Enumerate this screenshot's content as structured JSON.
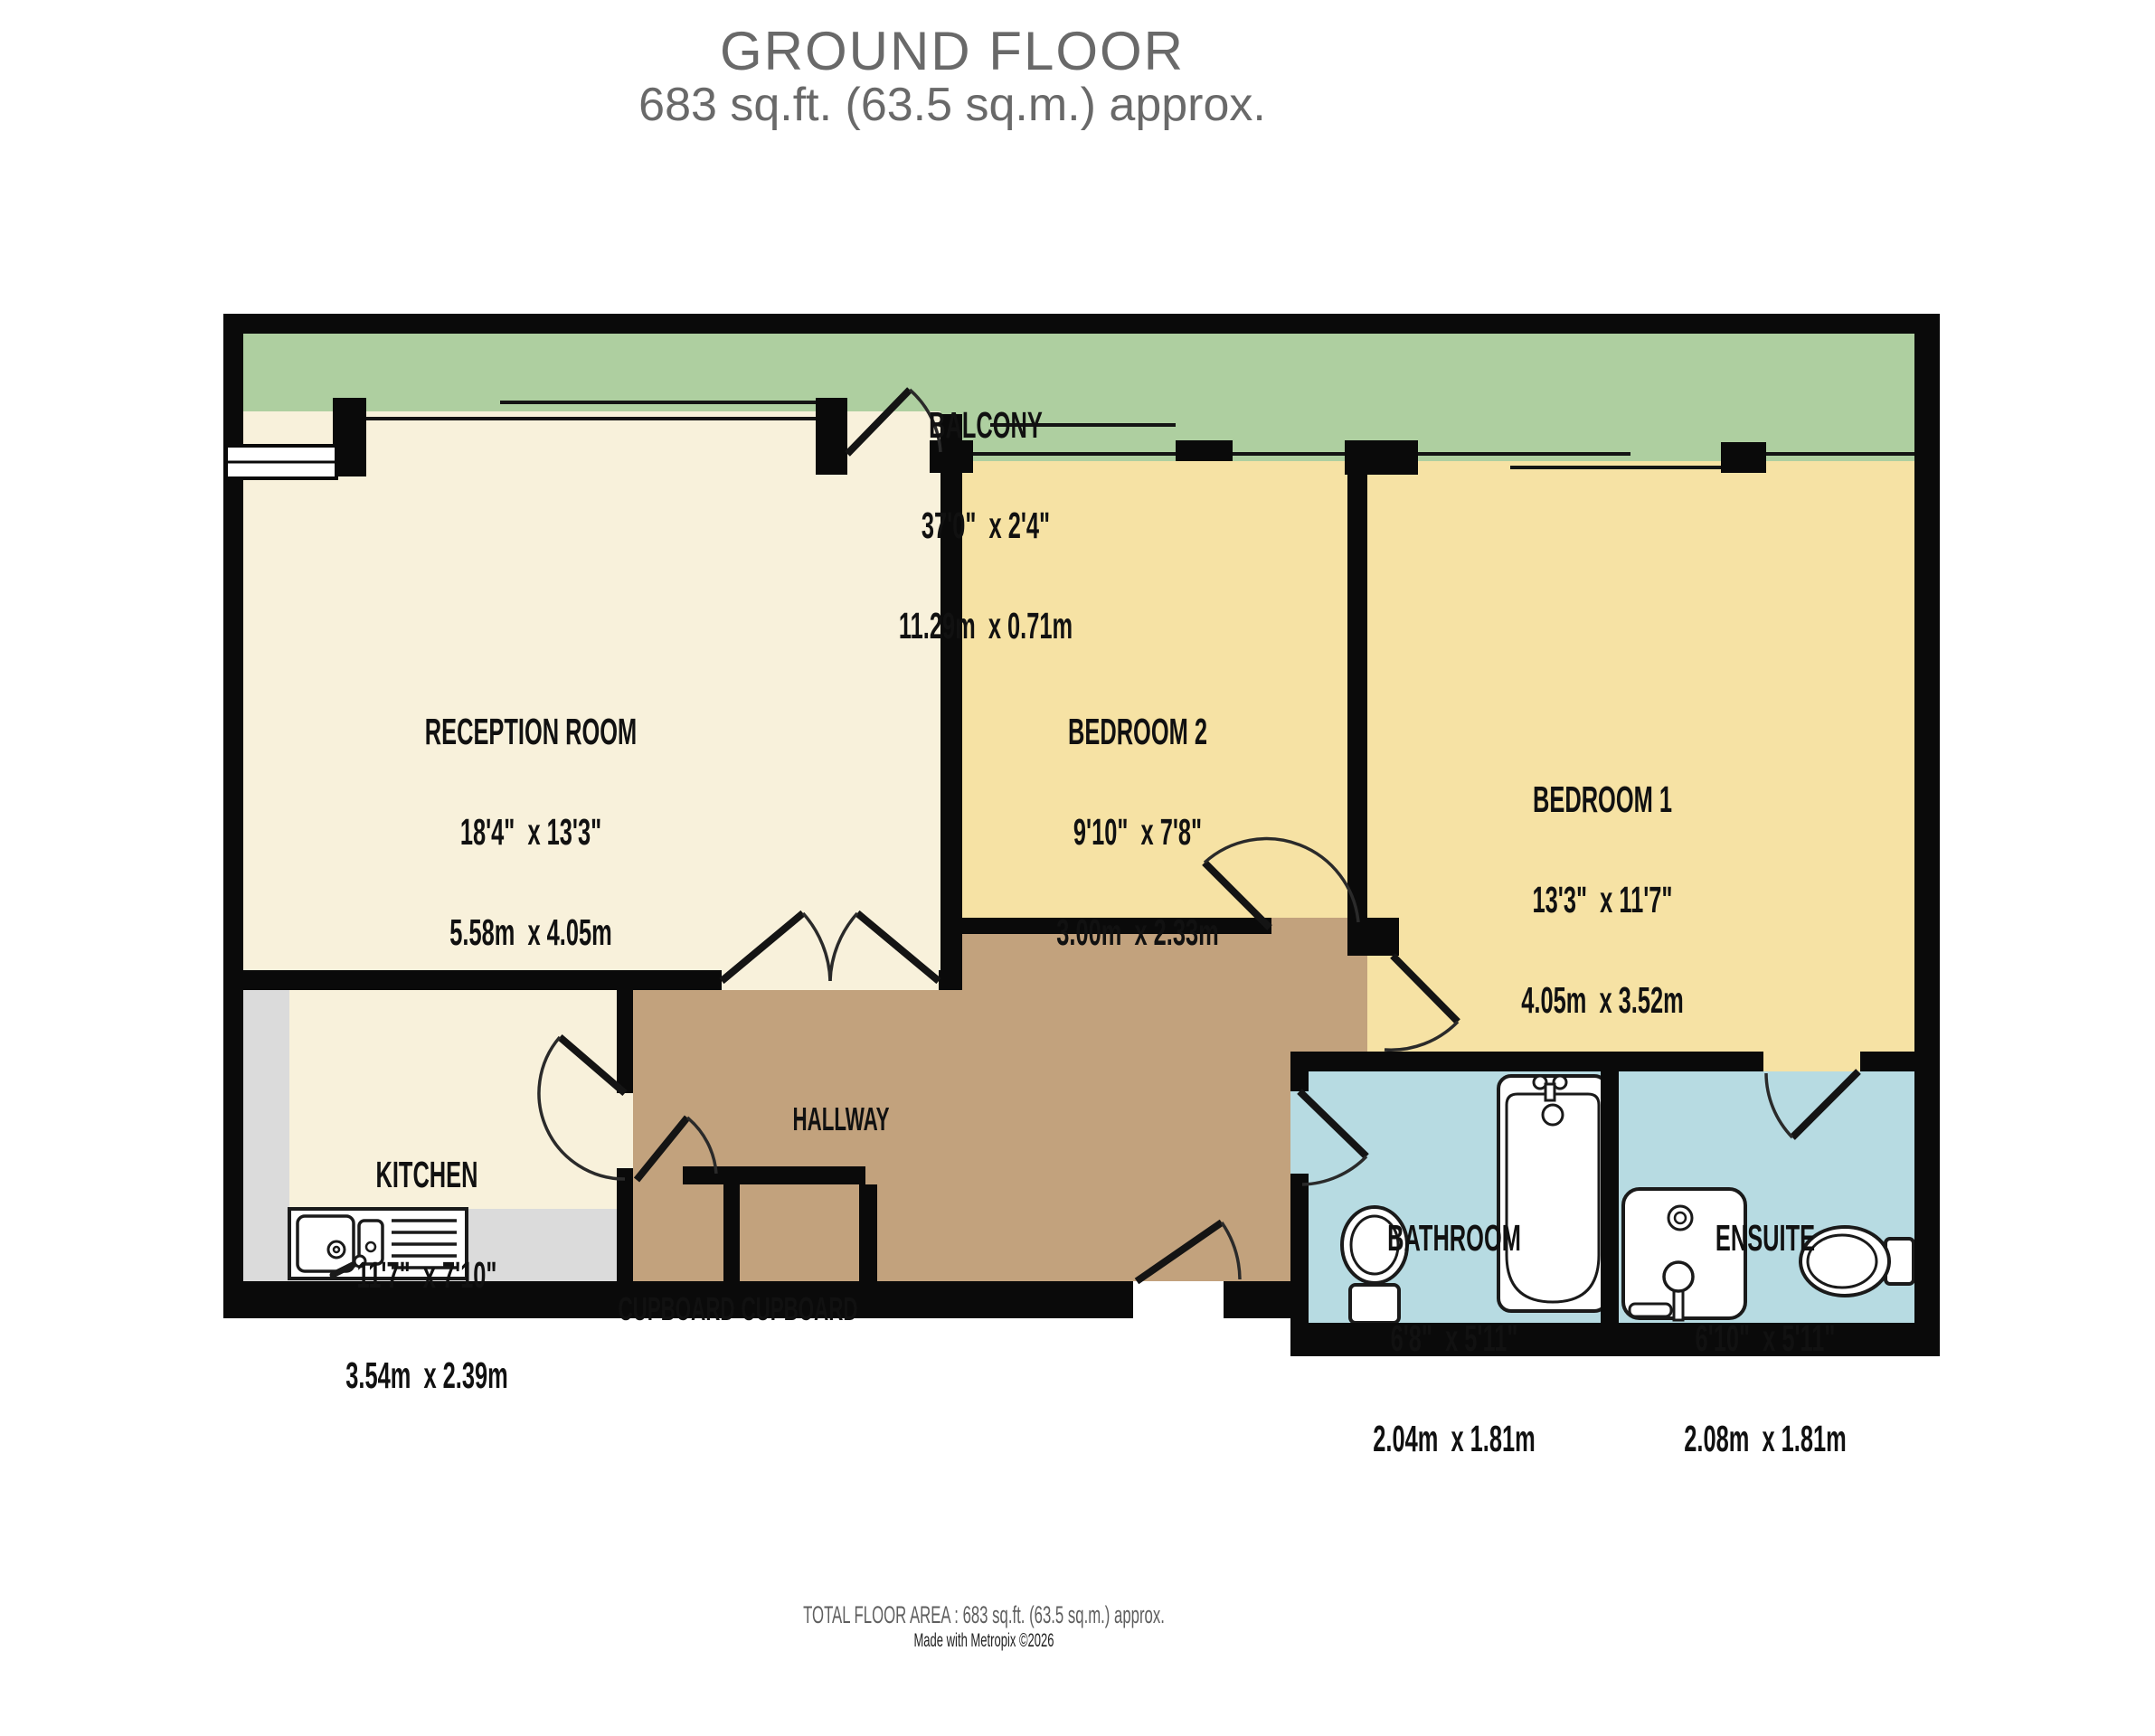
{
  "title": {
    "line1": "GROUND FLOOR",
    "line2": "683 sq.ft. (63.5 sq.m.) approx."
  },
  "rooms": {
    "balcony": {
      "name": "BALCONY",
      "imperial": "37'0\"  x 2'4\"",
      "metric": "11.29m  x 0.71m"
    },
    "reception": {
      "name": "RECEPTION ROOM",
      "imperial": "18'4\"  x 13'3\"",
      "metric": "5.58m  x 4.05m"
    },
    "bedroom2": {
      "name": "BEDROOM 2",
      "imperial": "9'10\"  x 7'8\"",
      "metric": "3.00m  x 2.33m"
    },
    "bedroom1": {
      "name": "BEDROOM 1",
      "imperial": "13'3\"  x 11'7\"",
      "metric": "4.05m  x 3.52m"
    },
    "kitchen": {
      "name": "KITCHEN",
      "imperial": "11'7\"  x 7'10\"",
      "metric": "3.54m  x 2.39m"
    },
    "hallway": {
      "name": "HALLWAY"
    },
    "cupboard_left": {
      "name": "CUPBOARD"
    },
    "cupboard_right": {
      "name": "CUPBOARD"
    },
    "bathroom": {
      "name": "BATHROOM",
      "imperial": "6'8\"  x 5'11\"",
      "metric": "2.04m  x 1.81m"
    },
    "ensuite": {
      "name": "ENSUITE",
      "imperial": "6'10\"  x 5'11\"",
      "metric": "2.08m  x 1.81m"
    }
  },
  "footer": {
    "area": "TOTAL FLOOR AREA : 683 sq.ft. (63.5 sq.m.) approx.",
    "credit": "Made with Metropix ©2026"
  },
  "colors": {
    "wall": "#0a0a0a",
    "balcony": "#aecfa0",
    "cream": "#f8f1db",
    "bedroom": "#f6e2a4",
    "hallway": "#c2a27d",
    "bath": "#b7dbe2",
    "kgray": "#dbdbdb",
    "label": "#111111",
    "titlegray": "#696969",
    "footgray": "#5e5e5e",
    "credit": "#222222"
  }
}
